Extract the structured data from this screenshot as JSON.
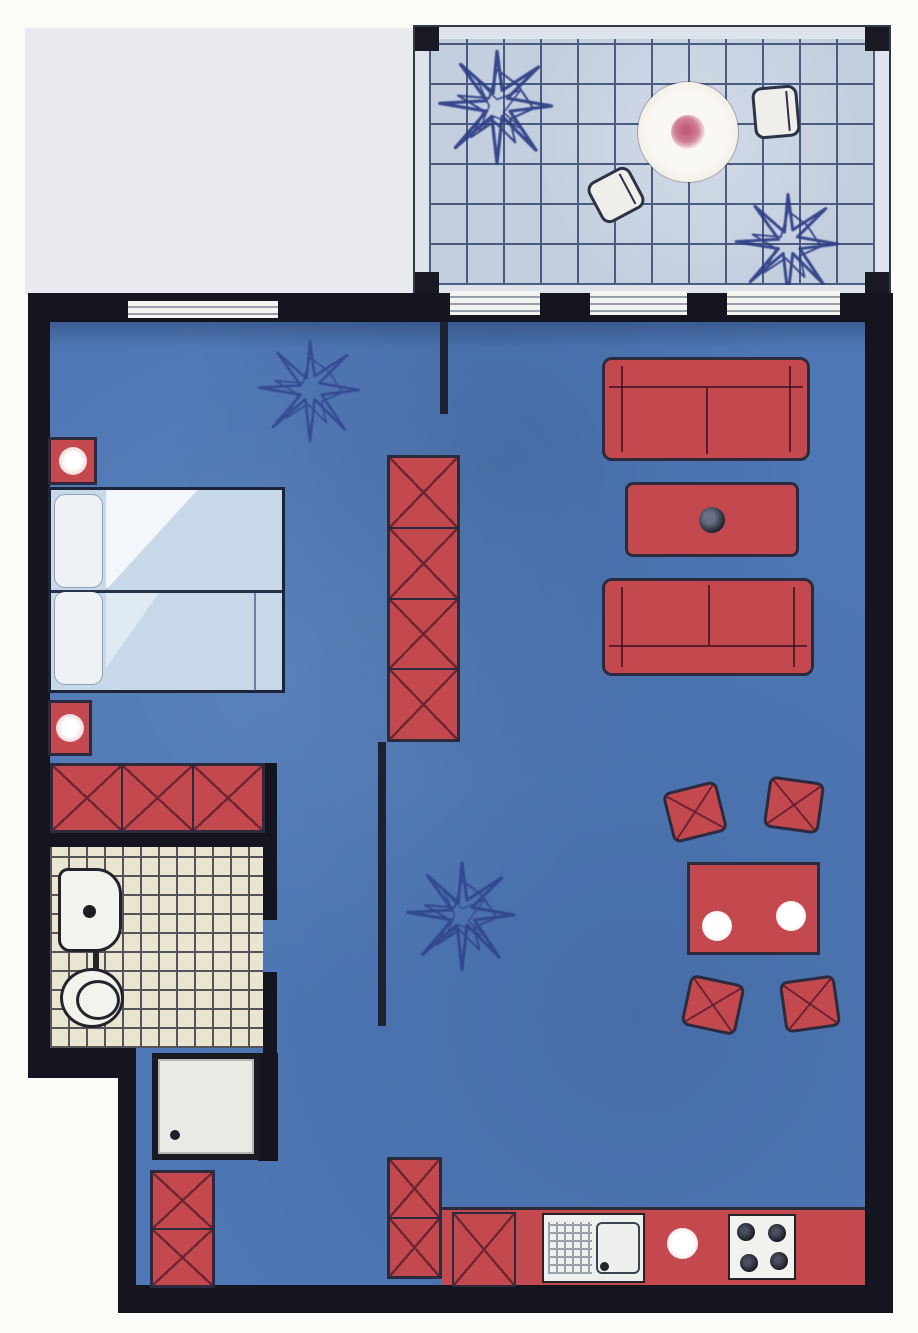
{
  "document": {
    "title": "Apartment floor plan",
    "description": "Hand-coloured architectural floor plan of a one-bedroom apartment with a tiled balcony, blue-floored living/sleeping area, bathroom with shower, and kitchenette"
  },
  "colors": {
    "paper": "#fbfbf8",
    "outside_gray": "#e9eaed",
    "wall": "#15151f",
    "floor": "#4e78b5",
    "red": "#c4494f",
    "outline": "#2e2a3e",
    "balcony_tile": "#c3cede",
    "balcony_grid": "#4a5c80",
    "balcony_rail": "#dfe3ec",
    "bath_tile": "#eae5d1",
    "bath_grid": "#54545a",
    "bed_linen": "#c7d8e9",
    "linen_white": "#eef2f5",
    "plant": "#2c3d86",
    "flower_pink": "#cf8093",
    "chair_white": "#efeee8"
  },
  "rooms": [
    {
      "name": "balcony",
      "features": [
        "tiled floor",
        "round table with flower centrepiece",
        "two chairs",
        "two potted plants"
      ]
    },
    {
      "name": "living-room",
      "features": [
        "two facing sofas",
        "coffee table with ashtray",
        "dining table with two place settings",
        "four dining chairs",
        "floor plant"
      ]
    },
    {
      "name": "bedroom",
      "features": [
        "double bed with pillows",
        "two nightstands with lamps",
        "three-drawer dresser",
        "four-section wardrobe",
        "floor plant"
      ]
    },
    {
      "name": "bathroom",
      "features": [
        "wash basin",
        "toilet",
        "shower cubicle with drain"
      ]
    },
    {
      "name": "kitchen",
      "features": [
        "base cabinets",
        "sink with drainboard",
        "worktop",
        "four-ring stove"
      ]
    }
  ]
}
